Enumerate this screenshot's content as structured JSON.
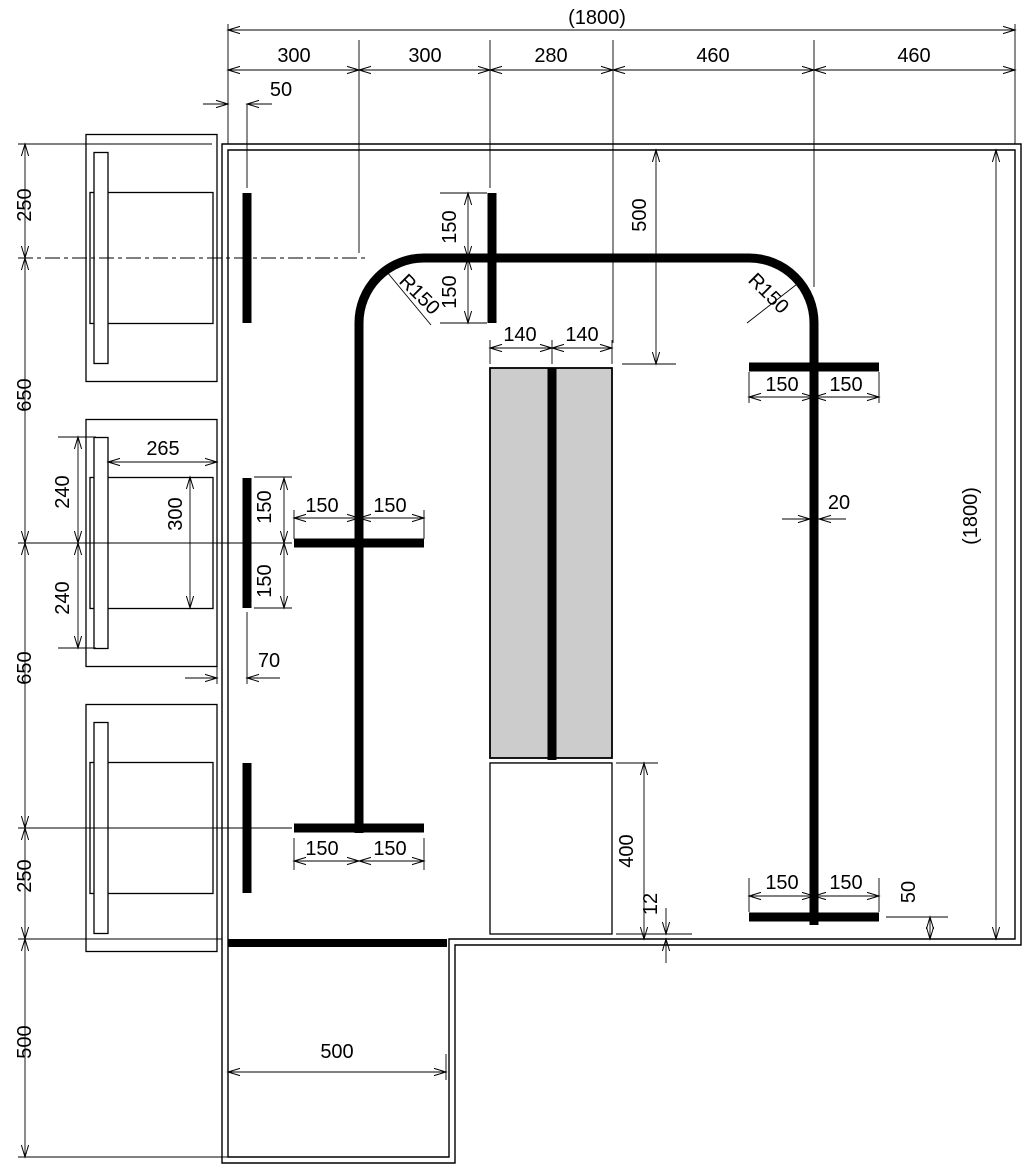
{
  "colors": {
    "dim_red": "#ee0000",
    "unit_gray": "#cccccc",
    "line_black": "#000000"
  },
  "labels": {
    "top_overall": "(1800)",
    "top_seg1": "300",
    "top_seg2": "300",
    "top_seg3": "280",
    "top_seg4": "460",
    "top_seg5": "460",
    "top_offset_50": "50",
    "left_seg1": "250",
    "left_seg2": "650",
    "left_seg3": "650",
    "left_seg4": "250",
    "left_bottom_500": "500",
    "seat_width_265": "265",
    "seat_240_upper": "240",
    "seat_240_lower": "240",
    "seat_depth_300": "300",
    "wall_tick_150_upper": "150",
    "wall_tick_150_lower": "150",
    "wall_offset_70": "70",
    "cross_mid_150_left": "150",
    "cross_mid_150_right": "150",
    "cross_bottom_150_left": "150",
    "cross_bottom_150_right": "150",
    "tick_top_150_upper": "150",
    "tick_top_150_lower": "150",
    "radius_left": "R150",
    "radius_right": "R150",
    "drop_500": "500",
    "unit_140_left": "140",
    "unit_140_right": "140",
    "right_cross_top_150_left": "150",
    "right_cross_top_150_right": "150",
    "tape_width_20": "20",
    "right_overall": "(1800)",
    "right_cross_bottom_150_left": "150",
    "right_cross_bottom_150_right": "150",
    "bottom_offset_50": "50",
    "unit_height_400": "400",
    "gap_12": "12",
    "ext_width_500": "500"
  }
}
